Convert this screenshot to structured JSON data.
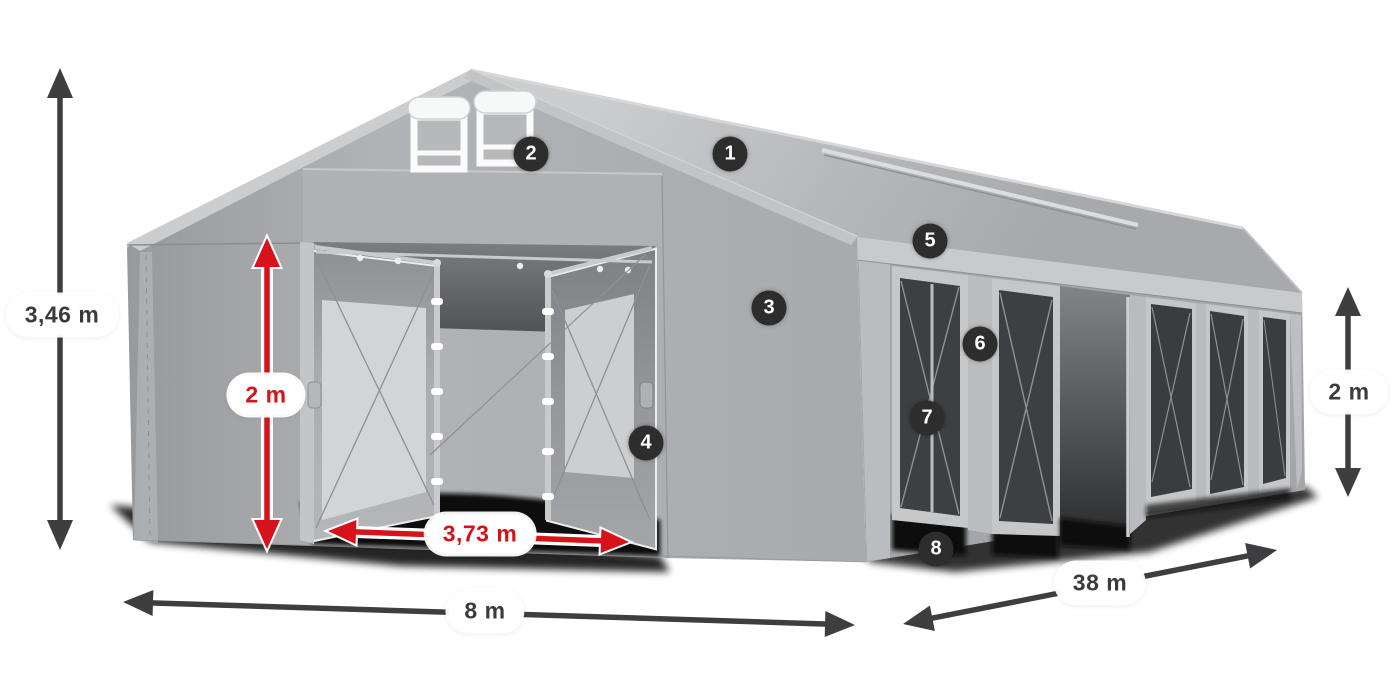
{
  "diagram": {
    "subject": "tent-dimension-diagram",
    "dimensions": {
      "total_height": "3,46 m",
      "entrance_height": "2 m",
      "entrance_width": "3,73 m",
      "front_width": "8 m",
      "side_length": "38 m",
      "side_wall_height": "2 m"
    },
    "callouts": [
      "1",
      "2",
      "3",
      "4",
      "5",
      "6",
      "7",
      "8"
    ],
    "colors": {
      "dimension_red": "#d6121b",
      "dimension_dark": "#3e3e40",
      "callout_background": "#2d2d2e",
      "tent_fabric_gray": "#b0b2b5",
      "background": "#ffffff"
    }
  }
}
